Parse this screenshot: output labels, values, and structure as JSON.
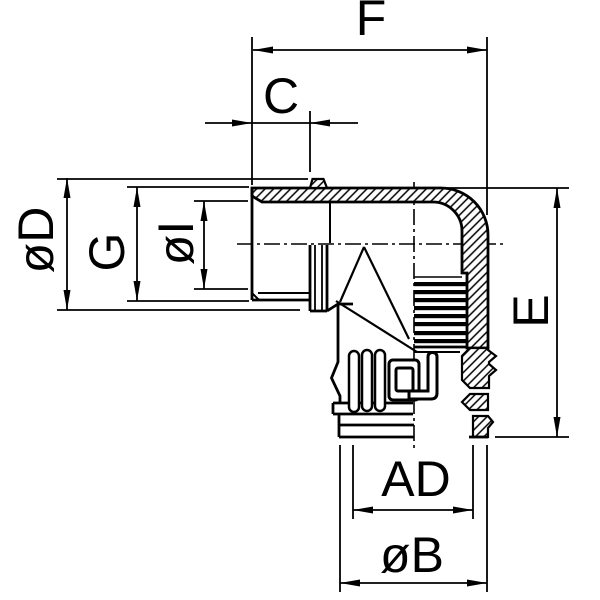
{
  "drawing": {
    "title": "90-degree elbow conduit fitting - dimension drawing",
    "view": "half-section side view",
    "background_color": "#ffffff",
    "line_color": "#000000",
    "dimensions": [
      {
        "label": "F",
        "axis": "horizontal",
        "location": "top",
        "measures": "overall length from male thread face to outer elbow wall"
      },
      {
        "label": "C",
        "axis": "horizontal",
        "location": "top",
        "measures": "male thread length to stop flange"
      },
      {
        "label": "øD",
        "axis": "vertical",
        "location": "left",
        "measures": "flange outer diameter"
      },
      {
        "label": "G",
        "axis": "vertical",
        "location": "left",
        "measures": "male thread outer diameter"
      },
      {
        "label": "øI",
        "axis": "vertical",
        "location": "left",
        "measures": "bore inner diameter"
      },
      {
        "label": "E",
        "axis": "vertical",
        "location": "right",
        "measures": "overall height"
      },
      {
        "label": "AD",
        "axis": "horizontal",
        "location": "bottom",
        "measures": "bottom opening diameter"
      },
      {
        "label": "øB",
        "axis": "horizontal",
        "location": "bottom",
        "measures": "bottom outer diameter"
      }
    ]
  }
}
